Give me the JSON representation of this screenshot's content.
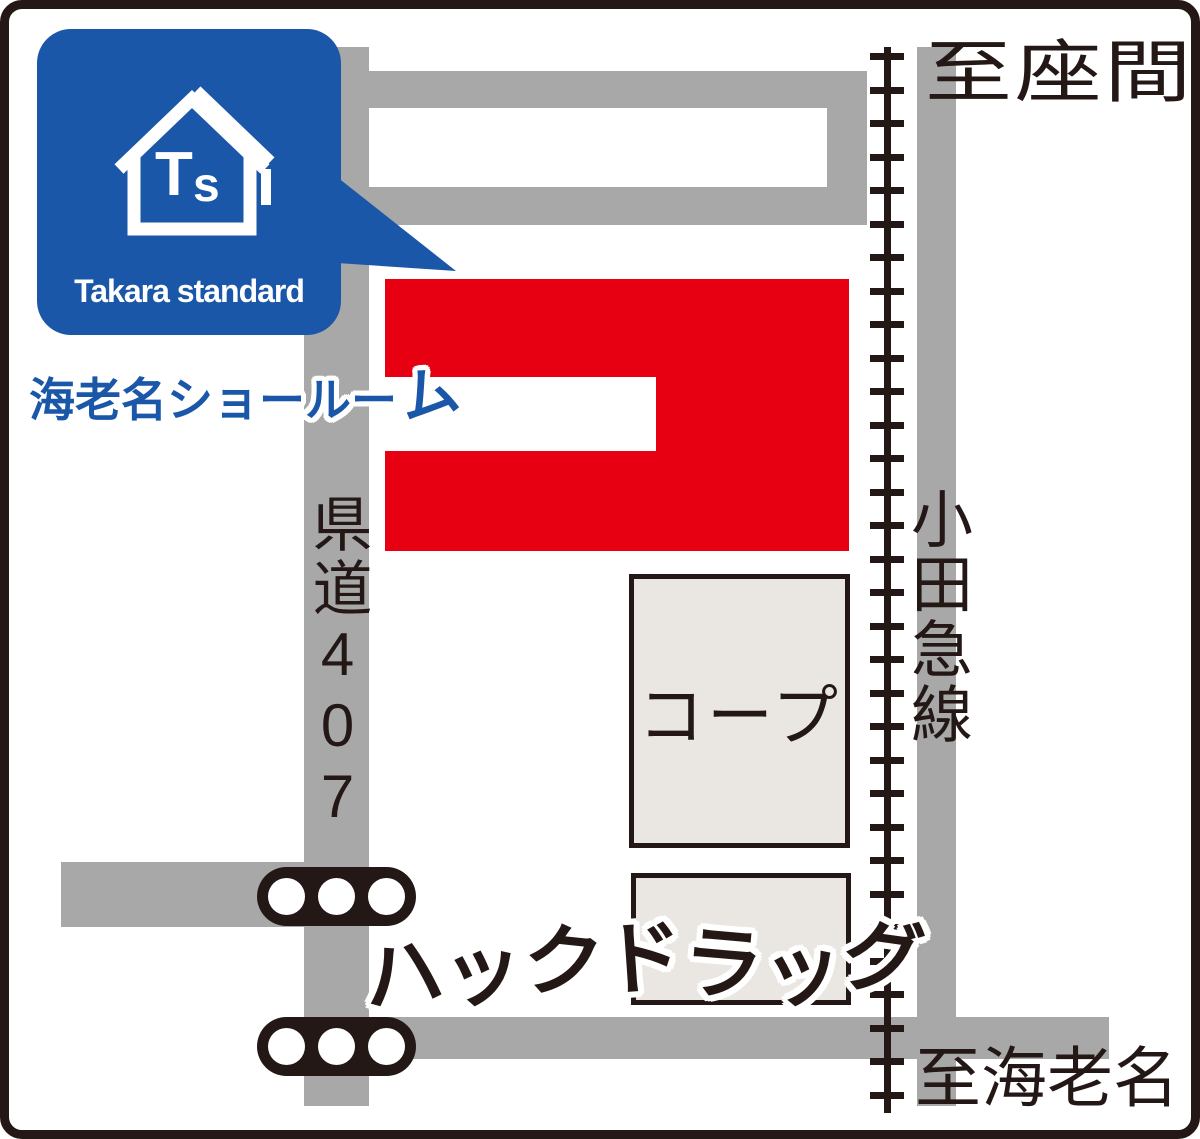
{
  "colors": {
    "ink": "#231815",
    "road": "#a8a8a9",
    "red": "#e60012",
    "blue": "#1a57a8",
    "building_fill": "#eae7e2",
    "white": "#ffffff"
  },
  "logo_card": {
    "brand": "Takara standard",
    "monogram": "Ts",
    "showroom": "海老名ショールーム"
  },
  "labels": {
    "to_zama": "至座間",
    "to_ebina": "至海老名",
    "railway_line": "小田急線",
    "pref_road": "県道407"
  },
  "buildings": {
    "coop": "コープ",
    "hack_drug": "ハックドラッグ"
  }
}
